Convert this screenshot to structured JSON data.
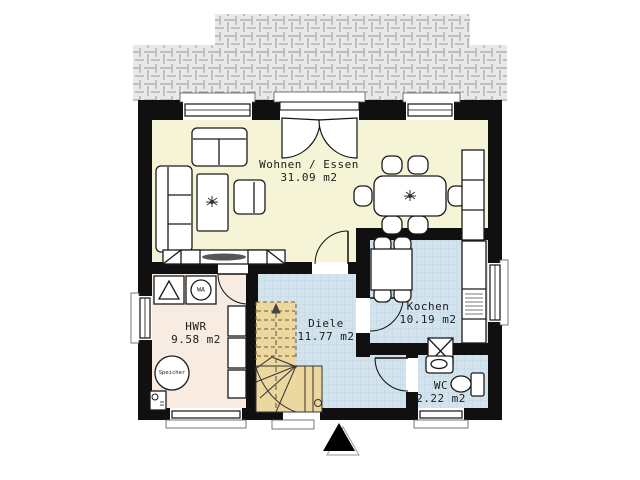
{
  "plan": {
    "rooms": [
      {
        "id": "wohnen-essen",
        "label": "Wohnen / Essen",
        "area": "31.09 m2"
      },
      {
        "id": "kochen",
        "label": "Kochen",
        "area": "10.19 m2"
      },
      {
        "id": "diele",
        "label": "Diele",
        "area": "11.77 m2"
      },
      {
        "id": "hwr",
        "label": "HWR",
        "area": "9.58 m2"
      },
      {
        "id": "wc",
        "label": "WC",
        "area": "2.22 m2"
      }
    ],
    "appliances": {
      "washing_machine": "WA",
      "storage_tank": "Speicher"
    },
    "colors": {
      "living_floor": "#f6f4d6",
      "tiled_floor": "#d2e3ee",
      "utility_floor": "#f8ebe2",
      "stairs": "#ecd79e",
      "walls": "#101010",
      "terrace": "#e9e9e9"
    }
  }
}
